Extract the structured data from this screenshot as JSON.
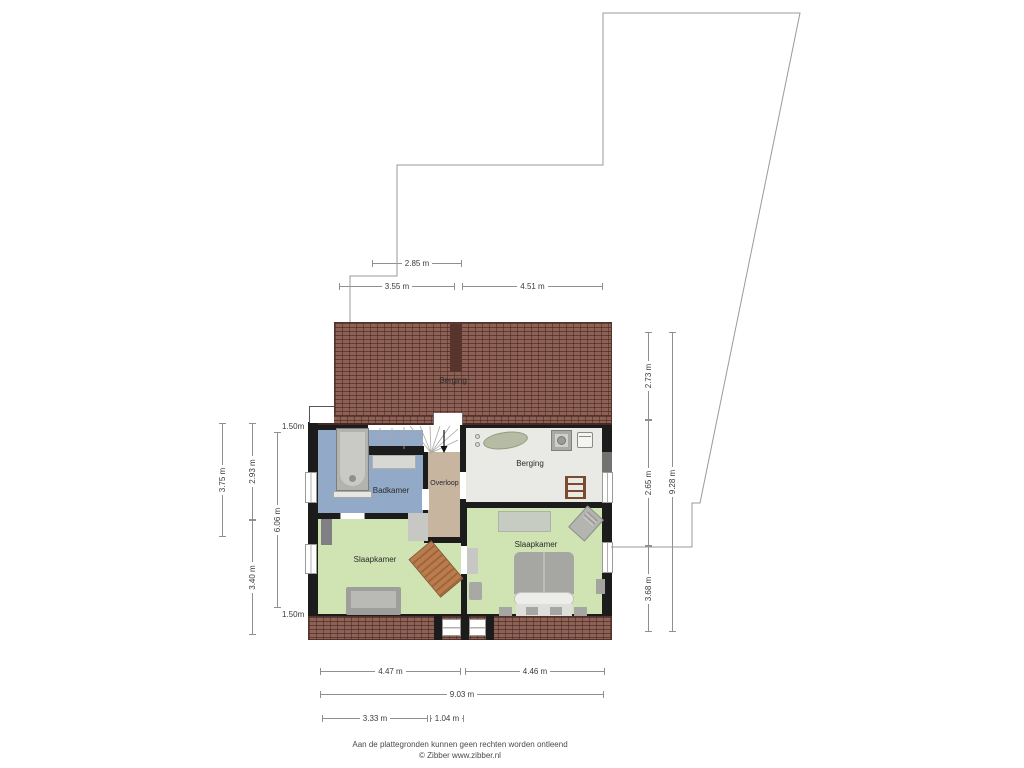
{
  "rooms": {
    "attic": "Berging",
    "bathroom": "Badkamer",
    "landing": "Overloop",
    "storage": "Berging",
    "bedroom_left": "Slaapkamer",
    "bedroom_right": "Slaapkamer"
  },
  "dims": {
    "top_width": "2.85 m",
    "top_left": "3.55 m",
    "top_right": "4.51 m",
    "left_outer": "3.75 m",
    "left_upper": "2.93 m",
    "left_lower": "3.40 m",
    "left_clearance_top": "1.50m",
    "left_inner": "6.06 m",
    "left_clearance_bottom": "1.50m",
    "right_upper": "2.73 m",
    "right_middle": "2.65 m",
    "right_lower": "3.68 m",
    "right_total": "9.28 m",
    "bottom_left": "4.47 m",
    "bottom_right": "4.46 m",
    "bottom_total": "9.03 m",
    "bottom_seg_left": "3.33 m",
    "bottom_seg_mid": "1.04 m"
  },
  "footer": {
    "disclaimer": "Aan de plattegronden kunnen geen rechten worden ontleend",
    "copyright": "© Zibber www.zibber.nl"
  },
  "colors": {
    "roof_brown": "#8d6156",
    "wall_black": "#1c1c1c",
    "bathroom_blue": "#92a9c7",
    "landing_tan": "#c8b5a0",
    "storage_gray": "#e9e9e6",
    "bedroom_green": "#cfe3b3",
    "dim_line_gray": "#8f8f8f"
  },
  "furniture": [
    "bathtub",
    "vanity-counter",
    "washing-machine",
    "laundry-basket",
    "surfboard",
    "ladder",
    "wardrobe",
    "rug",
    "sofa",
    "dresser",
    "lounge-chair",
    "double-bed",
    "nightstand",
    "chair",
    "radiator",
    "door-leaf"
  ]
}
